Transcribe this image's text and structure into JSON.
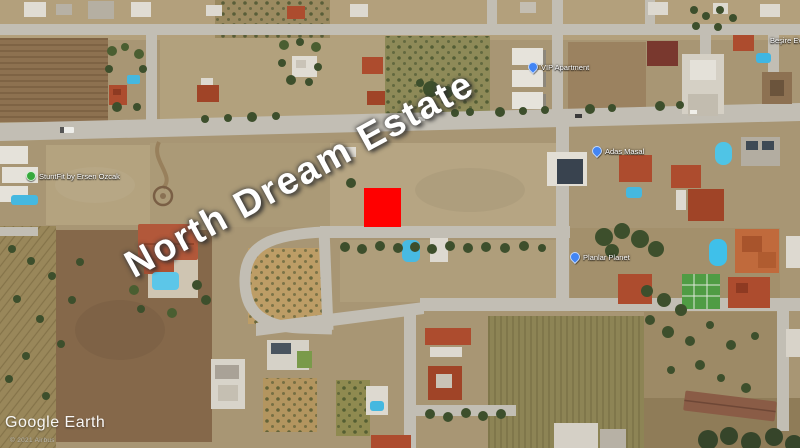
{
  "map": {
    "watermark_text": "North Dream Estate",
    "logo_text": "Google Earth",
    "copyright_text": "© 2021 Airbus",
    "marker": {
      "color": "#ff0000"
    }
  },
  "place_labels": [
    {
      "text": "StuntFit by Ersen Ozcak",
      "icon": "green-photo-pin"
    },
    {
      "text": "VIP Apartment",
      "icon": "blue-place-pin"
    },
    {
      "text": "Adas Masal",
      "icon": "blue-place-pin"
    },
    {
      "text": "Planlar Planet",
      "icon": "blue-place-pin"
    },
    {
      "text": "Beşire Ev",
      "icon": "none"
    }
  ],
  "colors": {
    "marker_red": "#ff0000",
    "road_gray": "#c2beb4",
    "terrain_tan": "#a89674",
    "roof_red": "#ad4c2e",
    "pool_blue": "#45b8e0",
    "tree_green": "#3d4f2c"
  }
}
